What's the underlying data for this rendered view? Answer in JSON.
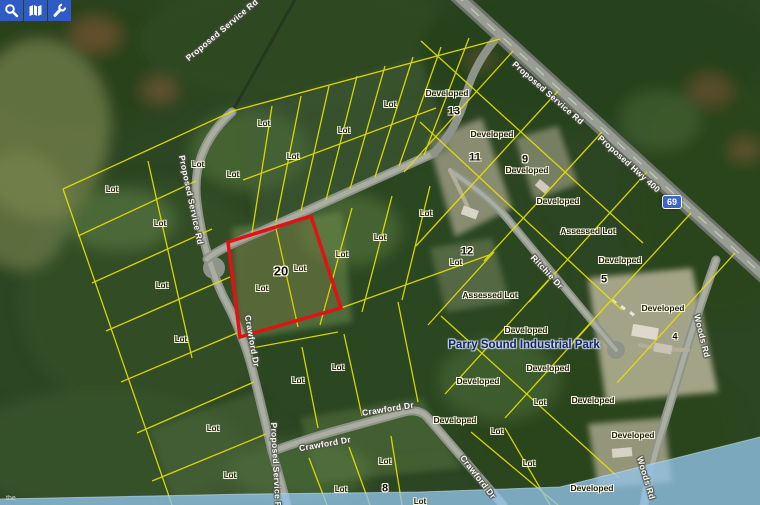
{
  "toolbar": {
    "buttons": [
      {
        "id": "search",
        "icon": "magnifier-icon"
      },
      {
        "id": "map-view",
        "icon": "map-icon"
      },
      {
        "id": "tools",
        "icon": "wrench-icon"
      }
    ]
  },
  "map": {
    "colors": {
      "parcel_line": "#e6e000",
      "highlight_outline": "#e11212",
      "road_fill": "#8f948a",
      "water": "#93c4ea"
    },
    "highlighted_lot": {
      "number": "20",
      "outline_color": "#e11212"
    },
    "highway_badge": {
      "text": "69",
      "color": "#3b66c9"
    },
    "park_label": {
      "text": "Parry Sound Industrial Park",
      "x": 524,
      "y": 345
    },
    "watermark_text": "the",
    "labels": {
      "lot": [
        {
          "text": "Lot",
          "x": 112,
          "y": 190
        },
        {
          "text": "Lot",
          "x": 160,
          "y": 224
        },
        {
          "text": "Lot",
          "x": 198,
          "y": 165
        },
        {
          "text": "Lot",
          "x": 233,
          "y": 175
        },
        {
          "text": "Lot",
          "x": 162,
          "y": 286
        },
        {
          "text": "Lot",
          "x": 181,
          "y": 340
        },
        {
          "text": "Lot",
          "x": 213,
          "y": 429
        },
        {
          "text": "Lot",
          "x": 230,
          "y": 476
        },
        {
          "text": "Lot",
          "x": 264,
          "y": 124
        },
        {
          "text": "Lot",
          "x": 293,
          "y": 157
        },
        {
          "text": "Lot",
          "x": 344,
          "y": 131
        },
        {
          "text": "Lot",
          "x": 390,
          "y": 105
        },
        {
          "text": "Lot",
          "x": 342,
          "y": 255
        },
        {
          "text": "Lot",
          "x": 300,
          "y": 269
        },
        {
          "text": "Lot",
          "x": 262,
          "y": 289
        },
        {
          "text": "Lot",
          "x": 380,
          "y": 238
        },
        {
          "text": "Lot",
          "x": 426,
          "y": 214
        },
        {
          "text": "Lot",
          "x": 456,
          "y": 263
        },
        {
          "text": "Lot",
          "x": 298,
          "y": 381
        },
        {
          "text": "Lot",
          "x": 338,
          "y": 368
        },
        {
          "text": "Lot",
          "x": 497,
          "y": 432
        },
        {
          "text": "Lot",
          "x": 540,
          "y": 403
        },
        {
          "text": "Lot",
          "x": 529,
          "y": 464
        },
        {
          "text": "Lot",
          "x": 341,
          "y": 490
        },
        {
          "text": "Lot",
          "x": 385,
          "y": 462
        },
        {
          "text": "Lot",
          "x": 420,
          "y": 502
        }
      ],
      "numbers": [
        {
          "text": "20",
          "x": 281,
          "y": 271,
          "size": 13
        },
        {
          "text": "13",
          "x": 454,
          "y": 112
        },
        {
          "text": "11",
          "x": 475,
          "y": 158
        },
        {
          "text": "9",
          "x": 525,
          "y": 160
        },
        {
          "text": "12",
          "x": 467,
          "y": 252
        },
        {
          "text": "8",
          "x": 385,
          "y": 489
        },
        {
          "text": "5",
          "x": 604,
          "y": 280
        },
        {
          "text": "4",
          "x": 675,
          "y": 337,
          "size": 9
        }
      ],
      "status": [
        {
          "text": "Developed",
          "x": 447,
          "y": 93
        },
        {
          "text": "Developed",
          "x": 492,
          "y": 134
        },
        {
          "text": "Developed",
          "x": 527,
          "y": 170
        },
        {
          "text": "Developed",
          "x": 558,
          "y": 201
        },
        {
          "text": "Assessed Lot",
          "x": 588,
          "y": 231
        },
        {
          "text": "Developed",
          "x": 620,
          "y": 260
        },
        {
          "text": "Developed",
          "x": 663,
          "y": 308
        },
        {
          "text": "Assessed Lot",
          "x": 490,
          "y": 295
        },
        {
          "text": "Developed",
          "x": 526,
          "y": 330
        },
        {
          "text": "Developed",
          "x": 548,
          "y": 368
        },
        {
          "text": "Developed",
          "x": 478,
          "y": 381
        },
        {
          "text": "Developed",
          "x": 593,
          "y": 400
        },
        {
          "text": "Developed",
          "x": 455,
          "y": 420
        },
        {
          "text": "Developed",
          "x": 633,
          "y": 435
        },
        {
          "text": "Developed",
          "x": 592,
          "y": 488
        }
      ],
      "roads": [
        {
          "text": "Proposed Service Rd",
          "x": 222,
          "y": 30,
          "rot": -40
        },
        {
          "text": "Proposed Service Rd",
          "x": 548,
          "y": 93,
          "rot": 41
        },
        {
          "text": "Proposed Service Rd",
          "x": 191,
          "y": 200,
          "rot": 78
        },
        {
          "text": "Proposed Service Rd",
          "x": 276,
          "y": 468,
          "rot": 87
        },
        {
          "text": "Proposed Hwy 400",
          "x": 629,
          "y": 164,
          "rot": 42
        },
        {
          "text": "Crawford Dr",
          "x": 252,
          "y": 341,
          "rot": 80
        },
        {
          "text": "Crawford Dr",
          "x": 325,
          "y": 444,
          "rot": -10
        },
        {
          "text": "Crawford Dr",
          "x": 388,
          "y": 409,
          "rot": -9
        },
        {
          "text": "Crawford Dr",
          "x": 478,
          "y": 477,
          "rot": 52
        },
        {
          "text": "Ritchie Dr",
          "x": 547,
          "y": 272,
          "rot": 47
        },
        {
          "text": "Woods Rd",
          "x": 702,
          "y": 336,
          "rot": 76
        },
        {
          "text": "Woods Rd",
          "x": 646,
          "y": 478,
          "rot": 73
        }
      ]
    }
  }
}
